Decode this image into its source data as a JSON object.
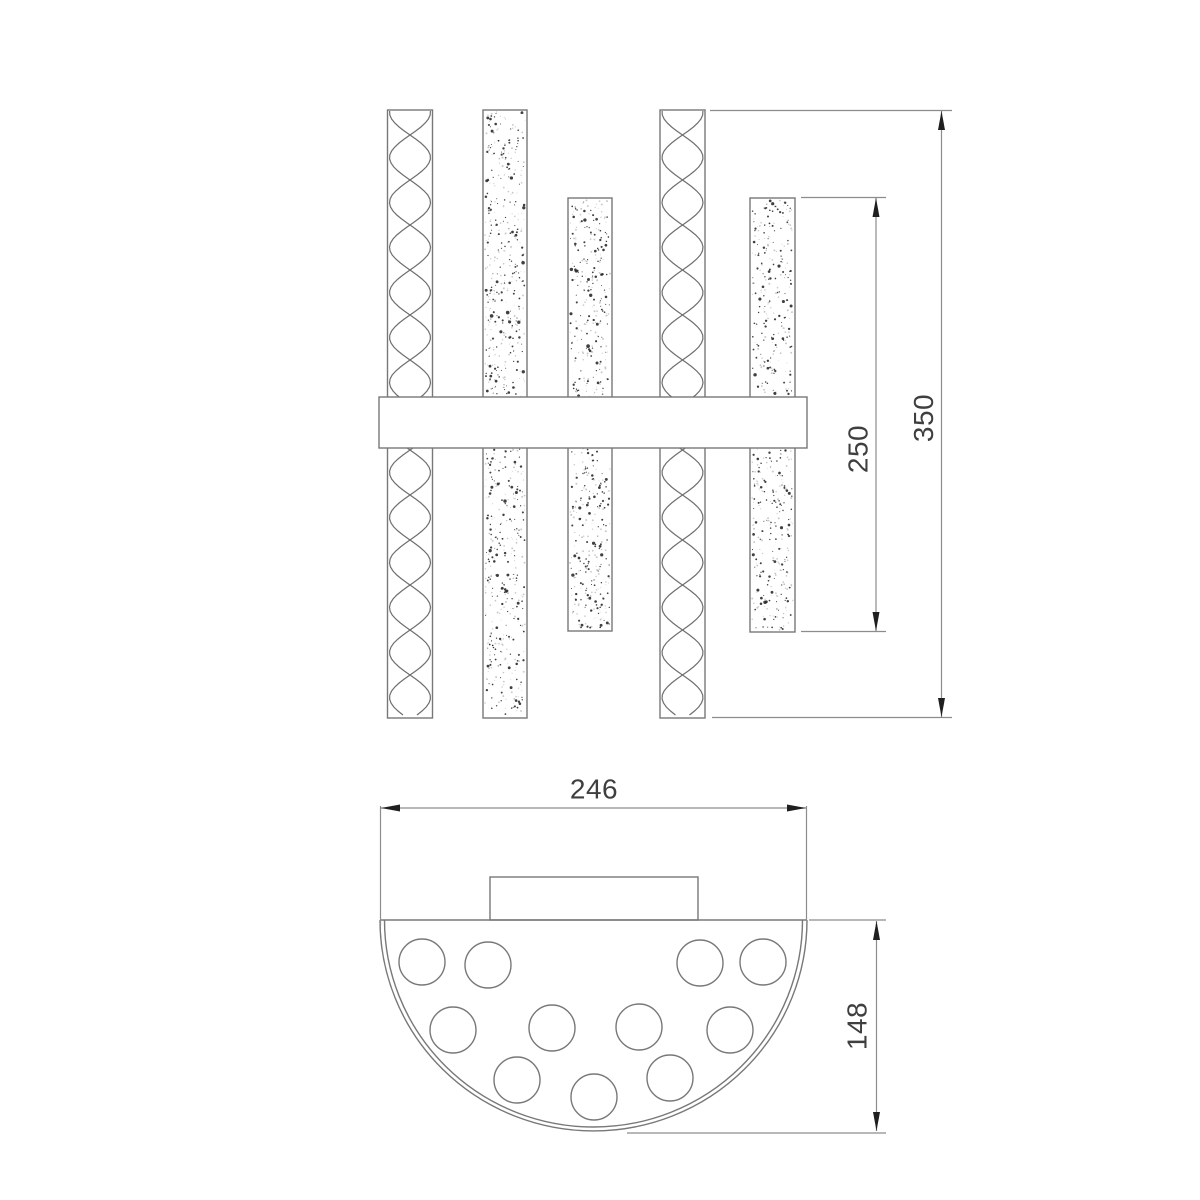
{
  "colors": {
    "background": "#ffffff",
    "object_line": "#787878",
    "dimension_line": "#8c8c8c",
    "arrowhead": "#1f1f1f",
    "label_text": "#3f3f3f",
    "stipple_dark_dot": "#2b2b2b",
    "stipple_light_dot": "#c8c8c8"
  },
  "front_view": {
    "dimensions": {
      "overall_height": {
        "label": "350"
      },
      "short_tube_height": {
        "label": "250"
      }
    }
  },
  "top_view": {
    "dimensions": {
      "overall_width": {
        "label": "246"
      },
      "depth": {
        "label": "148"
      }
    }
  }
}
